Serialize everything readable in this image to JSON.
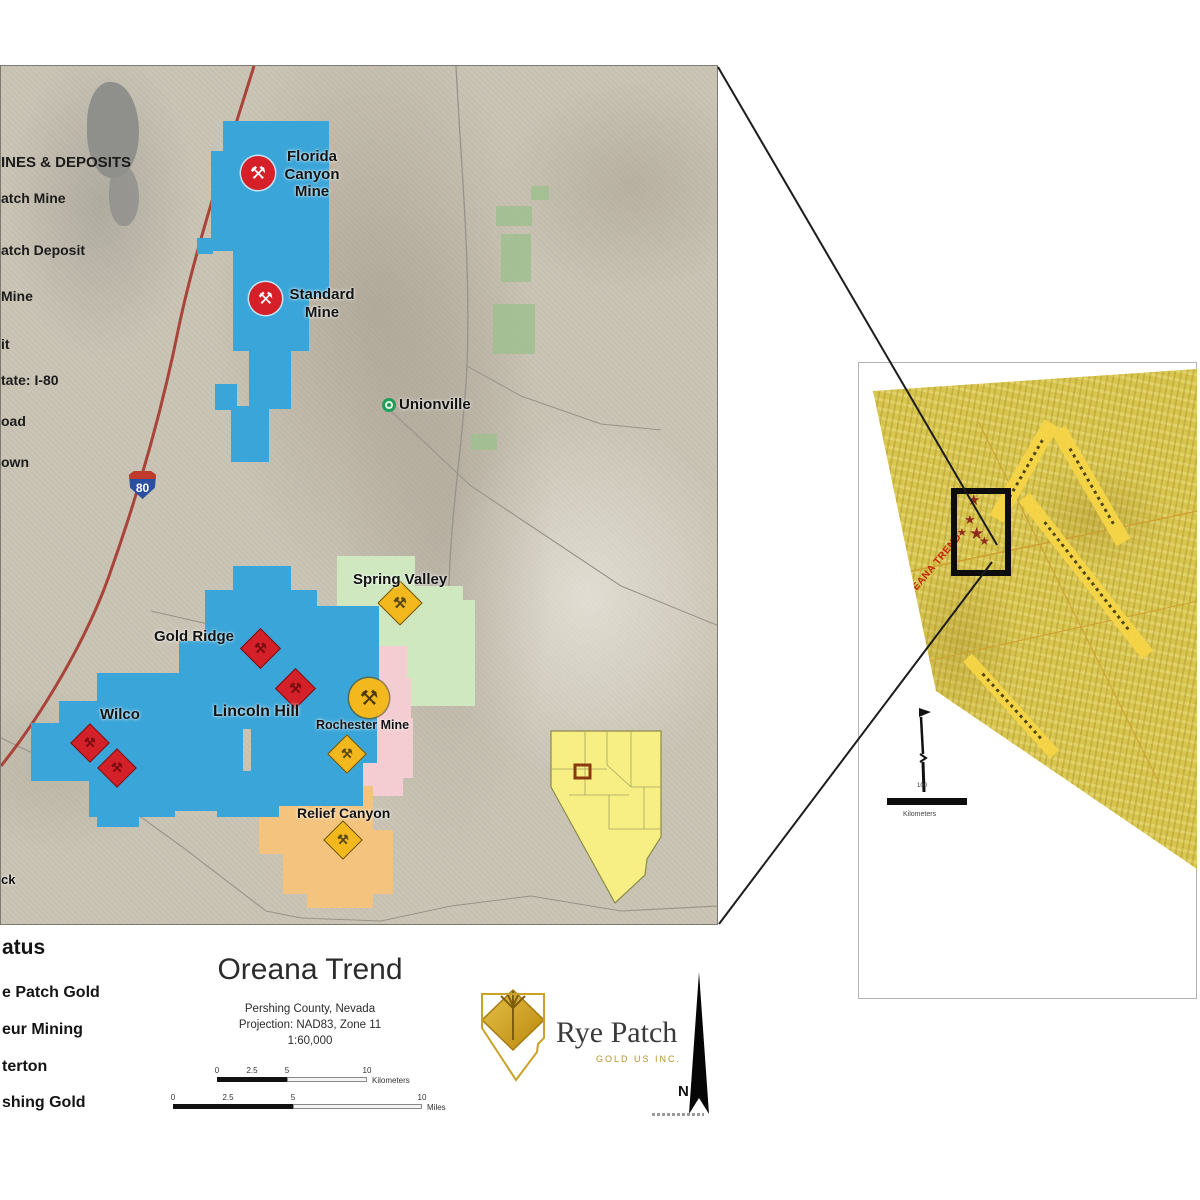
{
  "main_map": {
    "legend": {
      "title": "INES & DEPOSITS",
      "items": [
        "atch Mine",
        "atch Deposit",
        "Mine",
        "it",
        "tate: I-80",
        "oad",
        "own"
      ]
    },
    "shield_label": "80",
    "labels": {
      "florida": "Florida\nCanyon\nMine",
      "standard": "Standard\nMine",
      "unionville": "Unionville",
      "spring_valley": "Spring Valley",
      "gold_ridge": "Gold Ridge",
      "lincoln_hill": "Lincoln Hill",
      "wilco": "Wilco",
      "rochester": "Rochester Mine",
      "relief_canyon": "Relief Canyon",
      "edge_fragment": "ck"
    },
    "colors": {
      "claims_blue": "#3aa5d8",
      "claims_green": "#cfe8c0",
      "claims_pink": "#f3cdd1",
      "claims_orange": "#f4c47e",
      "marker_red": "#d52029",
      "marker_yellow": "#f2b81e",
      "highway_red": "#a8443a"
    }
  },
  "footer": {
    "status_title": "atus",
    "status_items": [
      "e Patch Gold",
      "eur Mining",
      "terton",
      "shing Gold"
    ],
    "title_block": {
      "title": "Oreana Trend",
      "line1": "Pershing County, Nevada",
      "line2": "Projection: NAD83, Zone 11",
      "line3": "1:60,000"
    },
    "scalebar_km": {
      "t0": "0",
      "t1": "2.5",
      "t2": "5",
      "t3": "10",
      "unit": "Kilometers"
    },
    "scalebar_mi": {
      "t0": "0",
      "t1": "2.5",
      "t2": "5",
      "t3": "10",
      "unit": "Miles"
    },
    "logo": {
      "name": "Rye Patch",
      "tagline": "GOLD US INC."
    },
    "north_label": "N"
  },
  "inset": {
    "trend_label": "OREANA TREND",
    "scalebar_tick": "100",
    "scalebar_unit": "Kilometers"
  },
  "icons": {
    "mine": "⚒",
    "star": "★"
  }
}
